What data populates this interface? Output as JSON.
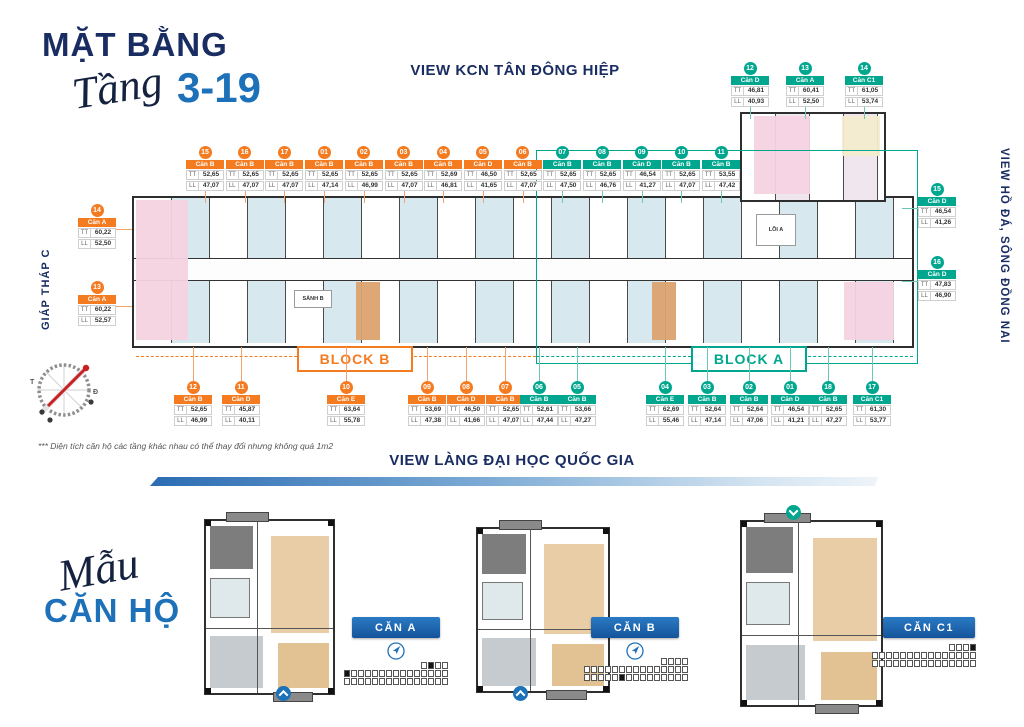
{
  "header": {
    "title": "MẶT BẰNG",
    "subtitle_script": "Tầng",
    "subtitle_range": "3-19"
  },
  "views": {
    "top": "VIEW KCN TÂN ĐÔNG HIỆP",
    "right": "VIEW HỒ ĐÁ, SÔNG ĐỒNG NAI",
    "left": "GIÁP THÁP C",
    "bottom": "VIEW LÀNG ĐẠI HỌC QUỐC GIA"
  },
  "blocks": {
    "block_b": {
      "label": "BLOCK B",
      "color": "#f47b20"
    },
    "block_a": {
      "label": "BLOCK A",
      "color": "#00a78e"
    }
  },
  "plan_labels": {
    "lobby_b": "SẢNH B",
    "core_a": "LÕI A"
  },
  "row_labels": {
    "tt": "TT",
    "ll": "LL"
  },
  "units": {
    "top_row": [
      {
        "no": "15",
        "type": "Căn B",
        "tt": "52,65",
        "ll": "47,07",
        "block": "B"
      },
      {
        "no": "16",
        "type": "Căn B",
        "tt": "52,65",
        "ll": "47,07",
        "block": "B"
      },
      {
        "no": "17",
        "type": "Căn B",
        "tt": "52,65",
        "ll": "47,07",
        "block": "B"
      },
      {
        "no": "01",
        "type": "Căn B",
        "tt": "52,65",
        "ll": "47,14",
        "block": "B"
      },
      {
        "no": "02",
        "type": "Căn B",
        "tt": "52,65",
        "ll": "46,99",
        "block": "B"
      },
      {
        "no": "03",
        "type": "Căn B",
        "tt": "52,65",
        "ll": "47,07",
        "block": "B"
      },
      {
        "no": "04",
        "type": "Căn B",
        "tt": "52,69",
        "ll": "46,81",
        "block": "B"
      },
      {
        "no": "05",
        "type": "Căn D",
        "tt": "46,50",
        "ll": "41,65",
        "block": "B"
      },
      {
        "no": "06",
        "type": "Căn B",
        "tt": "52,65",
        "ll": "47,07",
        "block": "B"
      },
      {
        "no": "07",
        "type": "Căn B",
        "tt": "52,65",
        "ll": "47,50",
        "block": "A"
      },
      {
        "no": "08",
        "type": "Căn B",
        "tt": "52,65",
        "ll": "46,76",
        "block": "A"
      },
      {
        "no": "09",
        "type": "Căn D",
        "tt": "46,54",
        "ll": "41,27",
        "block": "A"
      },
      {
        "no": "10",
        "type": "Căn B",
        "tt": "52,65",
        "ll": "47,07",
        "block": "A"
      },
      {
        "no": "11",
        "type": "Căn B",
        "tt": "53,55",
        "ll": "47,42",
        "block": "A"
      }
    ],
    "top_right": [
      {
        "no": "12",
        "type": "Căn D",
        "tt": "46,81",
        "ll": "40,93",
        "block": "A"
      },
      {
        "no": "13",
        "type": "Căn A",
        "tt": "60,41",
        "ll": "52,50",
        "block": "A"
      },
      {
        "no": "14",
        "type": "Căn C1",
        "tt": "61,05",
        "ll": "53,74",
        "block": "A"
      }
    ],
    "left_side": [
      {
        "no": "14",
        "type": "Căn A",
        "tt": "60,22",
        "ll": "52,50",
        "block": "B"
      },
      {
        "no": "13",
        "type": "Căn A",
        "tt": "60,22",
        "ll": "52,57",
        "block": "B"
      }
    ],
    "right_side": [
      {
        "no": "15",
        "type": "Căn D",
        "tt": "46,54",
        "ll": "41,26",
        "block": "A"
      },
      {
        "no": "16",
        "type": "Căn D",
        "tt": "47,83",
        "ll": "46,90",
        "block": "A"
      }
    ],
    "bottom_row": [
      {
        "no": "12",
        "type": "Căn B",
        "tt": "52,65",
        "ll": "46,99",
        "block": "B"
      },
      {
        "no": "11",
        "type": "Căn D",
        "tt": "45,87",
        "ll": "40,11",
        "block": "B"
      },
      {
        "no": "10",
        "type": "Căn E",
        "tt": "63,64",
        "ll": "55,78",
        "block": "B"
      },
      {
        "no": "09",
        "type": "Căn B",
        "tt": "53,69",
        "ll": "47,38",
        "block": "B"
      },
      {
        "no": "08",
        "type": "Căn D",
        "tt": "46,50",
        "ll": "41,66",
        "block": "B"
      },
      {
        "no": "07",
        "type": "Căn B",
        "tt": "52,65",
        "ll": "47,07",
        "block": "B"
      },
      {
        "no": "06",
        "type": "Căn B",
        "tt": "52,61",
        "ll": "47,44",
        "block": "A"
      },
      {
        "no": "05",
        "type": "Căn B",
        "tt": "53,66",
        "ll": "47,27",
        "block": "A"
      },
      {
        "no": "04",
        "type": "Căn E",
        "tt": "62,69",
        "ll": "55,46",
        "block": "A"
      },
      {
        "no": "03",
        "type": "Căn B",
        "tt": "52,64",
        "ll": "47,14",
        "block": "A"
      },
      {
        "no": "02",
        "type": "Căn B",
        "tt": "52,64",
        "ll": "47,06",
        "block": "A"
      },
      {
        "no": "01",
        "type": "Căn D",
        "tt": "46,54",
        "ll": "41,21",
        "block": "A"
      },
      {
        "no": "18",
        "type": "Căn B",
        "tt": "52,65",
        "ll": "47,27",
        "block": "A"
      },
      {
        "no": "17",
        "type": "Căn C1",
        "tt": "61,30",
        "ll": "53,77",
        "block": "A"
      }
    ]
  },
  "footnote": "*** Diện tích căn hộ các tầng khác nhau có thể thay đổi nhưng không quá 1m2",
  "models": {
    "title_script": "Mẫu",
    "title": "CĂN HỘ",
    "items": [
      {
        "label": "CĂN A",
        "keymap_filled": [
          [
            1,
            0
          ],
          [
            0,
            12
          ]
        ]
      },
      {
        "label": "CĂN B",
        "keymap_filled": [
          [
            2,
            5
          ]
        ]
      },
      {
        "label": "CĂN C1",
        "keymap_filled": [
          [
            0,
            14
          ]
        ]
      }
    ]
  }
}
